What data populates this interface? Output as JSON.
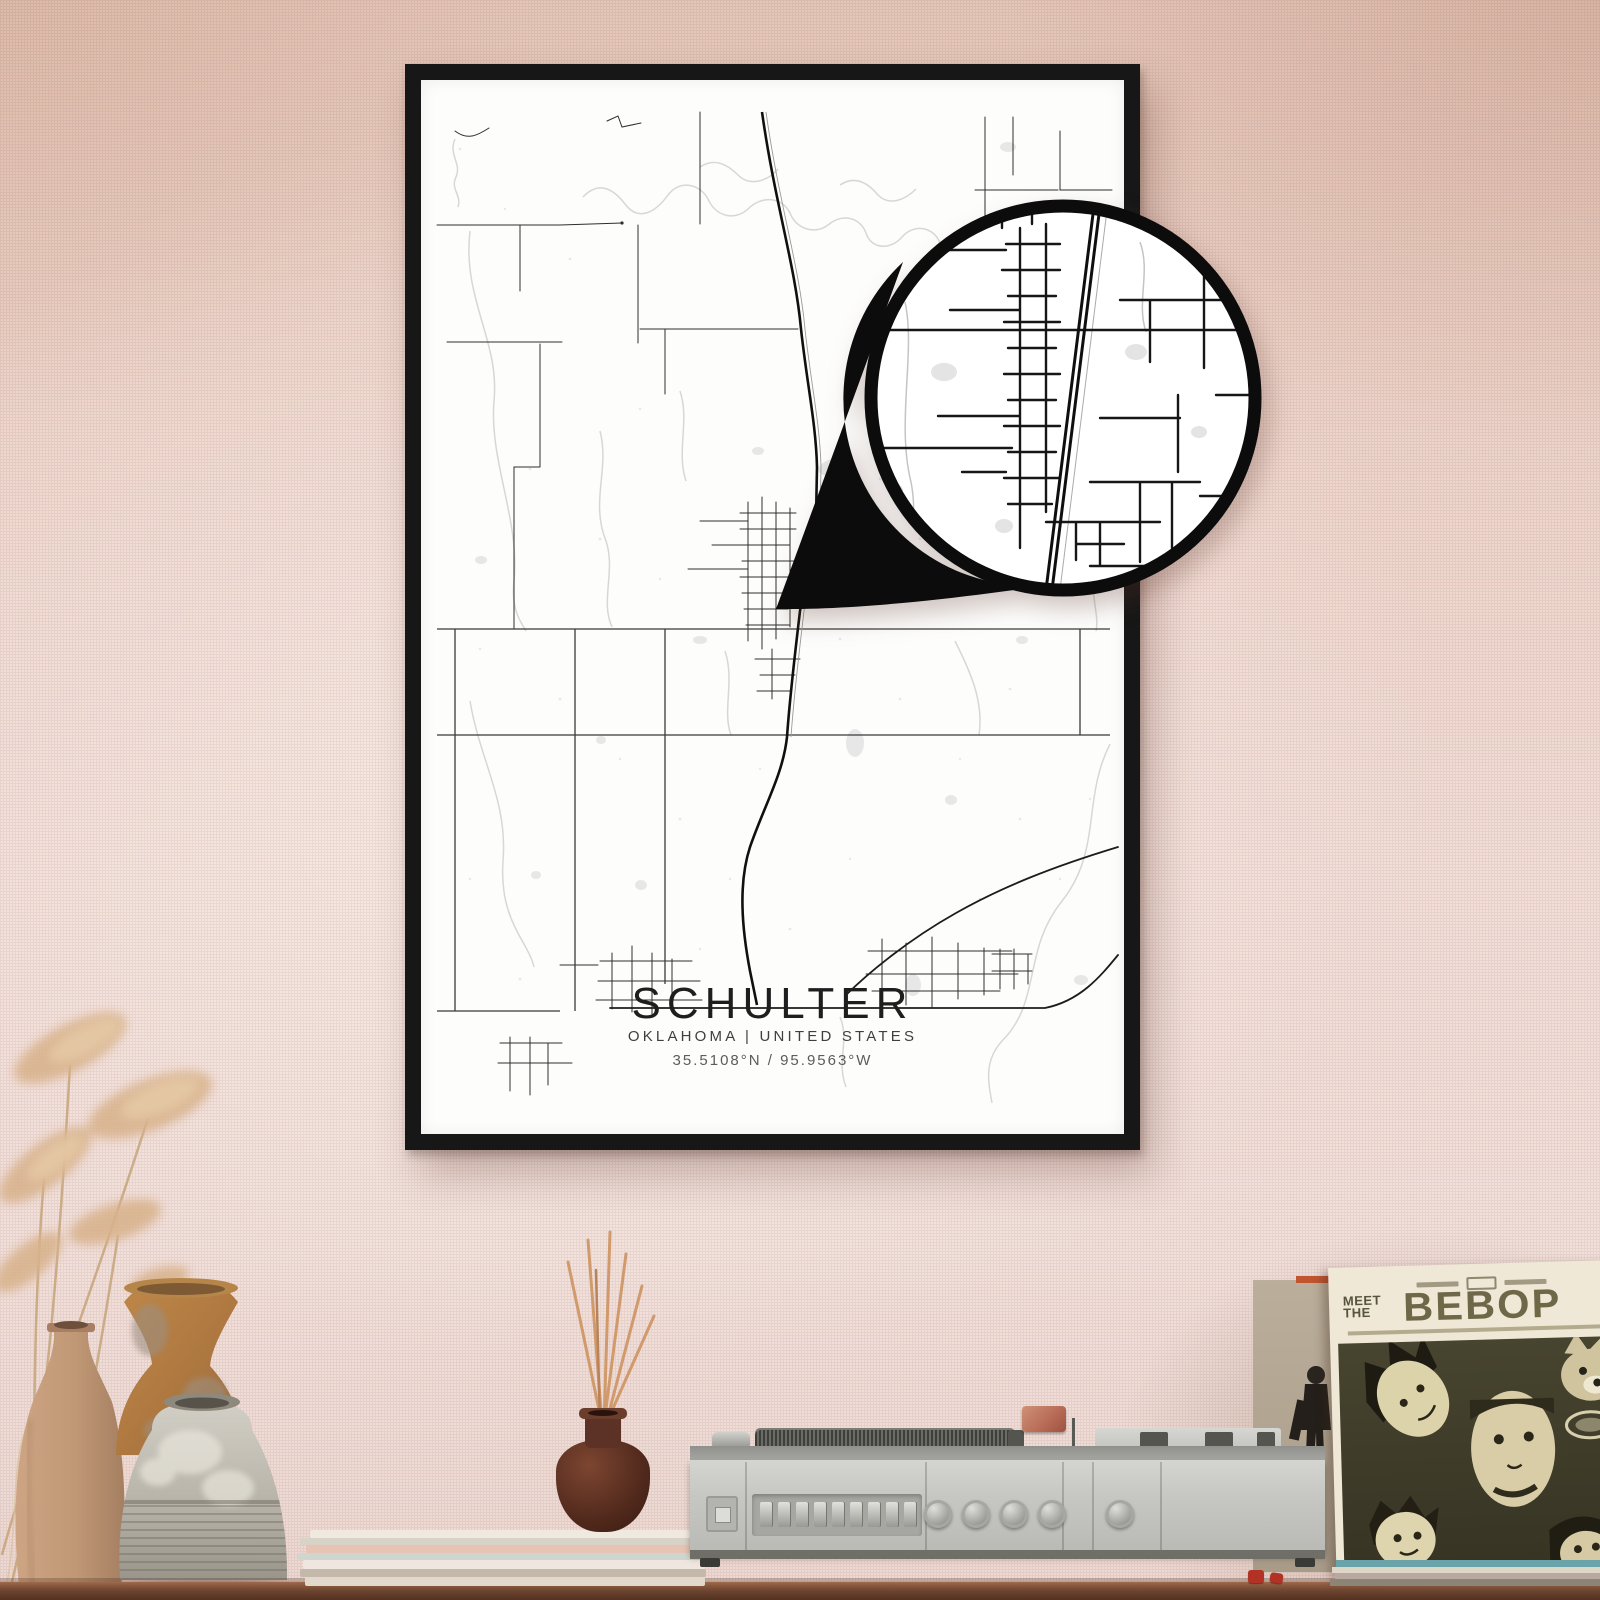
{
  "poster": {
    "title": "SCHULTER",
    "subtitle": "OKLAHOMA | UNITED STATES",
    "coordinates": "35.5108°N / 95.9563°W"
  },
  "album": {
    "pretitle_line1": "MEET",
    "pretitle_line2": "THE",
    "title": "BEBOP"
  },
  "colors": {
    "wall_pink": "#efd4ca",
    "frame_black": "#171717",
    "poster_paper": "#fdfdfc",
    "map_road": "#2e2e2e",
    "map_highway": "#101010",
    "map_water": "#d7d7d7",
    "shelf_wood": "#6b4430",
    "player_gray": "#c6c6c2",
    "album_olive": "#56543c",
    "diffuser_brown": "#50291c",
    "reed_tan": "#d09a6c",
    "pampas_tan": "#d8b28c",
    "accent_red": "#b23226",
    "record_teal": "#6ba3ab"
  }
}
